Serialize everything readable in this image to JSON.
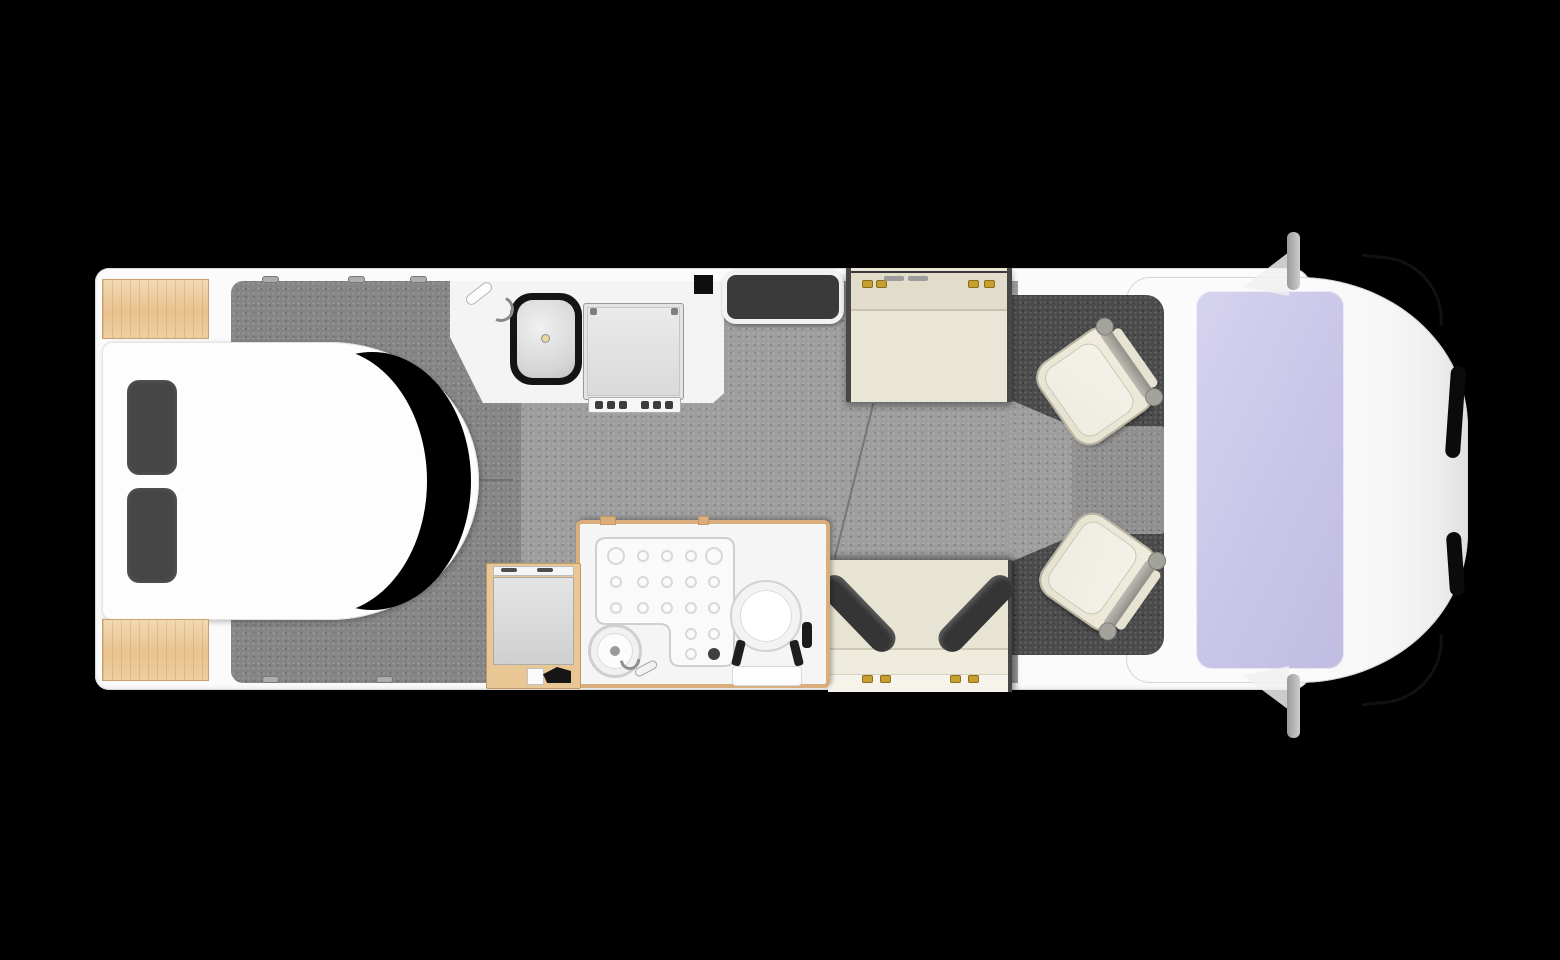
{
  "meta": {
    "title": "Motorhome floor plan — top-down view",
    "style": "3D rendered overhead floorplan of a coachbuilt motorhome on a black background",
    "orientation": "cab / front of vehicle on the right, rear bedroom on the left"
  },
  "palette": {
    "background": "#000000",
    "body_white": "#fbfbfb",
    "outline_grey": "#d6d6d6",
    "floor_main": "#9d9d9d",
    "floor_bedroom": "#858585",
    "cab_mat_charcoal": "#4a4a4a",
    "cab_floor_inner": "#8f8f8f",
    "upholstery_cream": "#eae6d6",
    "cushion_charcoal": "#3a3a3a",
    "wood_light": "#ecca9c",
    "wood_frame": "#d9ad7c",
    "windscreen_glass": "#c9c5e8",
    "metal_grey": "#a9a9a9",
    "buckle_gold": "#c79f2e",
    "ceramic_white": "#fcfcfc"
  },
  "areas": {
    "vehicle": {
      "label": "Motorhome floor plan (top view)"
    },
    "bedroom": {
      "label": "Rear bedroom",
      "floor": "Bedroom walk-around floor",
      "bed": "Island bed with rounded foot",
      "bed_shadow": "Shadow gap at bed foot",
      "pillow": "Charcoal pillow",
      "wardrobe_top": "Rear corner wardrobe (offside)",
      "wardrobe_bottom": "Rear corner wardrobe (nearside)",
      "latch": "Window latch"
    },
    "kitchen": {
      "label": "Kitchen",
      "worktop": "Kitchen worktop",
      "sink": "Inset sink with mixer tap",
      "tap": "Mixer tap",
      "hob": "Hob with control knobs"
    },
    "entry": {
      "label": "Entrance door step well"
    },
    "washroom": {
      "label": "Washroom",
      "shower": "Shower tray with drain",
      "basin": "Round washbasin with tap",
      "toilet": "Cassette toilet",
      "handle": "Washroom door handle",
      "wardrobe": "Wardrobe / fridge tower"
    },
    "lounge": {
      "label": "Half-dinette lounge",
      "floor": "Living area floor",
      "front_bench": "Forward-facing travel bench with seatbelts",
      "rear_bench": "Rear-facing bench seat",
      "cushion": "Angled back cushion",
      "buckle": "Seatbelt buckle"
    },
    "cab": {
      "label": "Driver cab",
      "mat": "Cab floor mat",
      "inner_floor": "Cab floor between seats",
      "seat_upper": "Swivelled cab seat (offside)",
      "seat_lower": "Swivelled cab seat (nearside)",
      "windscreen": "Windscreen",
      "mirror_top": "Wing mirror (offside)",
      "mirror_bottom": "Wing mirror (nearside)",
      "nose": "Cab front / bonnet",
      "trim": "Front grille trim"
    }
  }
}
